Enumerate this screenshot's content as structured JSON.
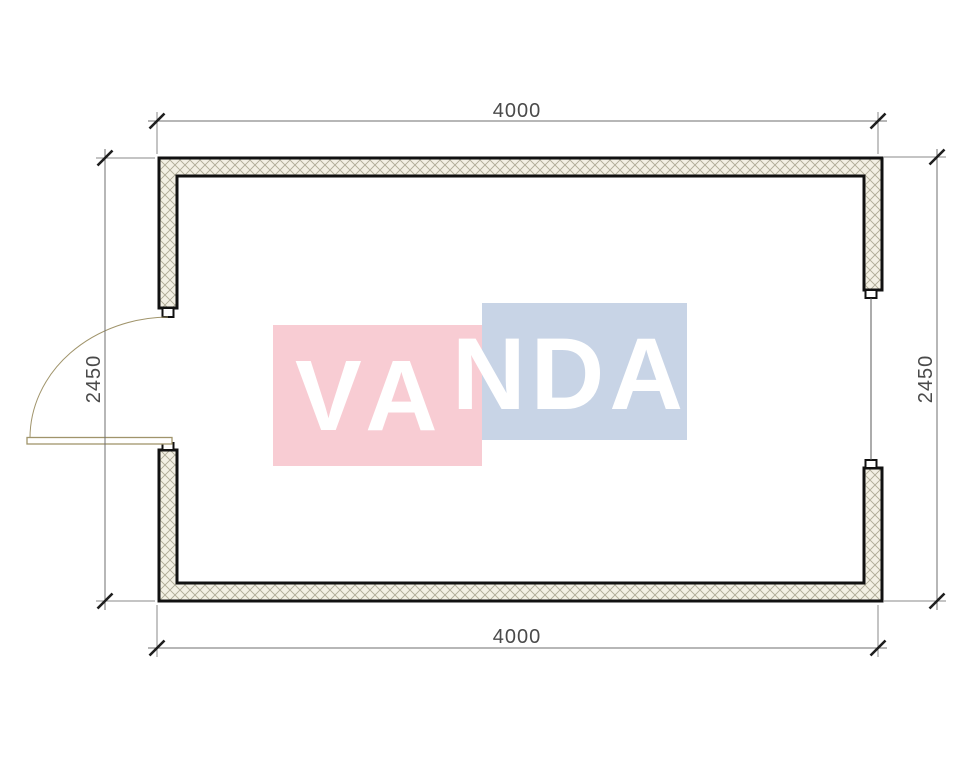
{
  "drawing": {
    "type": "floor-plan",
    "dimensions": {
      "top": "4000",
      "bottom": "4000",
      "left": "2450",
      "right": "2450"
    },
    "watermark": {
      "text": "VANDA",
      "part1": "VA",
      "part2": "NDA",
      "pink_color": "#f8ccd3",
      "blue_color": "#c8d4e6",
      "text_color": "#ffffff"
    },
    "colors": {
      "wall_hatch_background": "#f3f0e4",
      "hatch_line": "#aeaa96",
      "wall_outline": "#111111",
      "dimension_line": "#6f6f6f",
      "dimension_text": "#4a4a4a",
      "door_swing": "#a0946b"
    }
  }
}
